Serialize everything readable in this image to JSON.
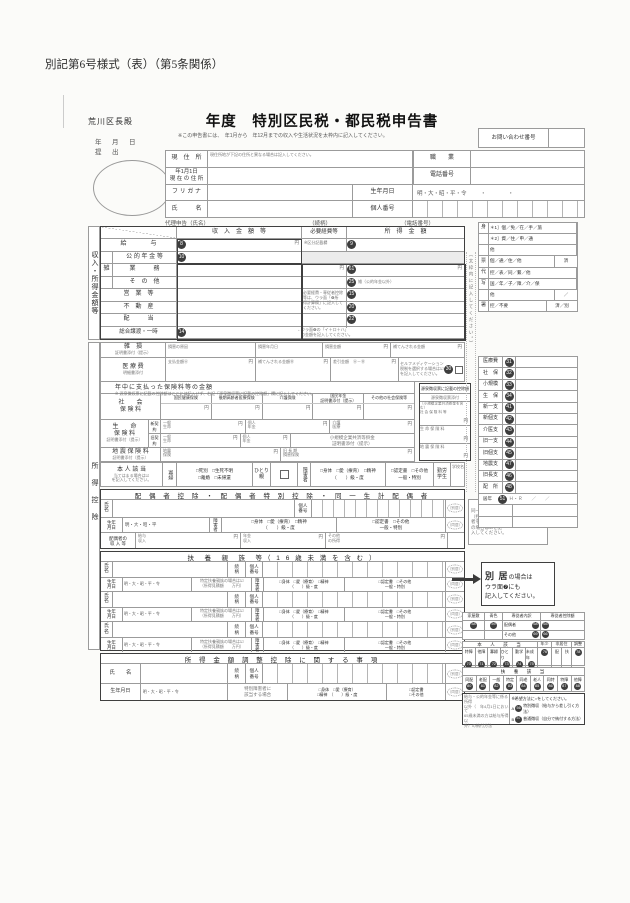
{
  "form_code": "別記第6号様式（表）（第5条関係）",
  "yen": "円",
  "stamps": {
    "bekkyo": "（別居）",
    "dokyo": "（同居）"
  },
  "header": {
    "addressee": "荒川区長殿",
    "submit_date": "年　月　日",
    "submit": "提　出",
    "title": "年度　特別区民税・都民税申告書",
    "subtitle": "※この申告書には、　年1月から　年12月までの収入や生活状況を太枠内に記入してください。",
    "inquiry": "お問い合わせ番号",
    "addr_label": "現　住　所",
    "addr_note": "現住所地が下記の住所と異なる場合は記入してください。",
    "job_label": "職　　業",
    "jan1_label": "年1月1日\n現 在 の 住 所",
    "tel_label": "電話番号",
    "furigana_label": "フ リ ガ ナ",
    "birth_label": "生年月日",
    "era": "明・大・昭・平・令",
    "era_dots": "・　　　　・",
    "name_label": "氏　　　名",
    "mynum_label": "個人番号",
    "proxy": "代理申告（氏名）",
    "proxy_rel": "（続柄）",
    "proxy_tel": "（電話番号）"
  },
  "income": {
    "rail": "収入・所得金額等",
    "h_revenue": "収　入　金　額　等",
    "h_expense": "必要経費等",
    "h_income": "所　得　金　額",
    "kubun": "※区分記載欄",
    "zatsu": "雑",
    "rows": {
      "kyuyo": "給　　　　与",
      "kyuyo_r": "8",
      "kyuyo_i": "9",
      "nenkin": "公 的 年 金 等",
      "nenkin_r": "10",
      "gyomu": "業　　　務",
      "gyomu_i": "61",
      "sonota": "そ　の　他",
      "sonota_i": "25",
      "sonota_note": "雑（公的年金以外）",
      "eigyo": "営　業　等",
      "eigyo_i": "15",
      "fudosan": "不　動　産",
      "fudosan_i": "20",
      "haito": "配　　　当",
      "haito_i": "22",
      "sogo": "総合譲渡・一時",
      "sogo_r": "14",
      "sogo_i": "26"
    },
    "expense_note": "必要経費・専従者控除\n等は、ウラ面「❻所\n得計算欄」に記入して\nください。",
    "sogo_note": "←ウラ面❻の「イ＋ロ＋ハ」\n　の金額を記入してください。"
  },
  "kojo": {
    "rail": "所得控除",
    "zasson": "雑　損",
    "zasson_sub": "証明書添付（提示）",
    "z_cause": "損害の原因",
    "z_date": "損害年月日",
    "z_amount": "損害金額",
    "z_comp": "補てんされる金額",
    "iryo": "医 療 費",
    "iryo_sub": "明細書添付",
    "i_paid": "支払金額Ⓐ",
    "i_comp": "補てんされる金額Ⓑ",
    "i_diff": "差引金額　Ⓐ－Ⓑ",
    "self_note": "セルフメディケーション\n税制を選択する場合は☑\nを記入してください。",
    "self_no": "30",
    "ins_title": "年中に支払った保険料等の金額",
    "ins_note": "※ 源泉徴収票に記載の控除額はここには記入せず、右記「源泉徴収票に記載の控除額」欄に記入してください。",
    "shakai": "社　　会\n保 険 料",
    "s_col_0": "国民健康保険",
    "s_col_1": "後期高齢者医療保険",
    "s_col_2": "介護保険",
    "s_col_3": "国民年金\n証明書添付（提示）",
    "s_col_4": "その他の社会保険等",
    "seimei": "生　　命\n保 険 料",
    "seimei_sub": "証明書添付（提示）",
    "shin": "新契約",
    "kyu": "旧契約",
    "ippan": "一般\n生命",
    "kojin_nenkin": "個人\n年金",
    "kaigo_iryo": "介護\n医療",
    "kyosai": "小規模企業共済等掛金\n証明書添付（提示）",
    "jishin": "地 震 保 険 料",
    "jishin_sub": "証明書添付（提示）",
    "jishin_c": "地震\n保険",
    "chouki_c": "旧 長 期\n損害保険",
    "gensen_title": "源泉徴収票に記載の控除額",
    "gensen_sub": "源泉徴収票添付",
    "gensen_r0": "（小規模企業共済掛金を含む）\n社 会 保 険 料 等",
    "gensen_r1": "生 命 保 険 料",
    "gensen_r2": "地 震 保 険 料"
  },
  "honnin": {
    "label": "本 人 該 当",
    "sub": "当てはまる場合は☑\nを記入してください。",
    "kafu": "寡婦",
    "kafu_opts": "□死別　□生死不明\n□離婚　□未帰還",
    "hitori": "ひとり\n親",
    "shogai": "障害者",
    "opts1": "□身体　□愛（療育）　□精神\n（　　）級・度",
    "opts2": "□認定書　□その他\n一般・特別",
    "kinro": "勤労\n学生",
    "school": "学校名"
  },
  "spouse": {
    "title": "配 偶 者 控 除 ・ 配 偶 者 特 別 控 除 ・ 同 一 生 計 配 偶 者",
    "name": "氏\n名",
    "zoku": "続\n柄",
    "mynum": "個人\n番号",
    "birth": "生年\n月日",
    "era": "明・大・昭・平",
    "shogai": "障害者",
    "income_label": "配偶者の\n収 入 等",
    "c1": "給与\n収入",
    "c2": "年金\n収入",
    "c3": "その他\nの所得",
    "note": "同一生計配偶者\n（控除対象配偶\n者を除く）\nの場合は☑を記\n入してください。"
  },
  "dependents": {
    "title": "扶　養　親　族　等（ 1 6 歳 未 満 を 含 む ）",
    "era": "明・大・昭・平・令",
    "tokutei": "特定扶養親族の場合は☑\n（所得見積額　　万円）"
  },
  "adjust": {
    "title": "所 得 金 額 調 整 控 除 に 関 す る 事 項",
    "name": "氏　　名",
    "birth": "生年月日",
    "tokushou": "特別障害者に\n該当する場合",
    "opts1": "□身体　□愛（療育）\n□精神　（　　）級・度",
    "opts2": "□認定書\n□その他"
  },
  "sidebar": {
    "vnote": "（太枠内に記入してください。）",
    "admin": [
      {
        "c": "身",
        "t": "＊1］個／免／在／手／旅",
        "r": ""
      },
      {
        "c": "",
        "t": "＊2］資／住／申／通",
        "r": ""
      },
      {
        "c": "",
        "t": "他",
        "r": ""
      },
      {
        "c": "票",
        "t": "個／通／住／他",
        "r": "済"
      },
      {
        "c": "代",
        "t": "控／表／同／繋／他",
        "r": ""
      },
      {
        "c": "写",
        "t": "国／年／子／障／介／保",
        "r": ""
      },
      {
        "c": "",
        "t": "他",
        "r": "／"
      },
      {
        "c": "署",
        "t": "控／不要",
        "r": "済／別"
      }
    ],
    "deductions": [
      {
        "l": "医療費",
        "n": "31",
        "x": ""
      },
      {
        "l": "社　保",
        "n": "32",
        "x": ""
      },
      {
        "l": "小規模",
        "n": "33",
        "x": ""
      },
      {
        "l": "生　保",
        "n": "34",
        "x": ""
      },
      {
        "l": "新一支",
        "n": "41",
        "x": ""
      },
      {
        "l": "新個支",
        "n": "42",
        "x": ""
      },
      {
        "l": "介医支",
        "n": "43",
        "x": ""
      },
      {
        "l": "旧一支",
        "n": "44",
        "x": ""
      },
      {
        "l": "旧個支",
        "n": "45",
        "x": ""
      },
      {
        "l": "地震支",
        "n": "47",
        "x": ""
      },
      {
        "l": "旧長支",
        "n": "46",
        "x": ""
      },
      {
        "l": "配　所",
        "n": "48",
        "x": ""
      },
      {
        "l": "居年",
        "n": "51",
        "x": "Ｈ・Ｒ　　／　　／"
      }
    ],
    "bekkyo_1": "別 居",
    "bekkyo_2": "の場合は",
    "bekkyo_3": "ウラ面❼にも",
    "bekkyo_4": "記入してください。",
    "senju": {
      "kaoku": "家屋敷",
      "kaoku_n": "58",
      "aoiro": "青色",
      "aoiro_n": "59",
      "uchiwake": "専従者内訳",
      "kojo": "専従者控除額",
      "haigu": "配偶者",
      "haigu_n": "68",
      "haigu_amt_n": "65",
      "sonota": "その他",
      "sonota_n": "69",
      "sonota_amt_n": "66",
      "honnin": "本　人　該　当",
      "items": [
        {
          "l": "特障",
          "n": "70"
        },
        {
          "l": "他障",
          "n": "71"
        },
        {
          "l": "寡婦",
          "n": "72"
        },
        {
          "l": "ひとり",
          "n": "73"
        },
        {
          "l": "勤学",
          "n": "74"
        },
        {
          "l": "未成年",
          "n": "75"
        }
      ],
      "nensho": "年少",
      "nensho_n": "76",
      "hikyoju": "非居住",
      "hai": "配",
      "fu": "扶",
      "chosei": "調整",
      "chosei_n": "78",
      "fuyo": "扶　養　該　当",
      "fuyo_items": [
        {
          "l": "同配",
          "n": "80"
        },
        {
          "l": "老配",
          "n": "81"
        },
        {
          "l": "一般",
          "n": "82"
        },
        {
          "l": "特定",
          "n": "83"
        },
        {
          "l": "同老",
          "n": "84"
        },
        {
          "l": "老人",
          "n": "85"
        },
        {
          "l": "同特",
          "n": "86"
        },
        {
          "l": "特障",
          "n": "87"
        },
        {
          "l": "他障",
          "n": "88"
        }
      ]
    },
    "payment": {
      "left": "給与・公的年金等に係る所得\n以外（　年4月1日において\n65歳未満の方は給与所得以\n外）の納付方法",
      "note": "※希望方法に○をしてください。",
      "a": "A",
      "a_n": "56",
      "a_t": "特別徴収（給与から差し引く方法）",
      "b": "B",
      "b_n": "57",
      "b_t": "普通徴収（自分で納付する方法）"
    }
  }
}
